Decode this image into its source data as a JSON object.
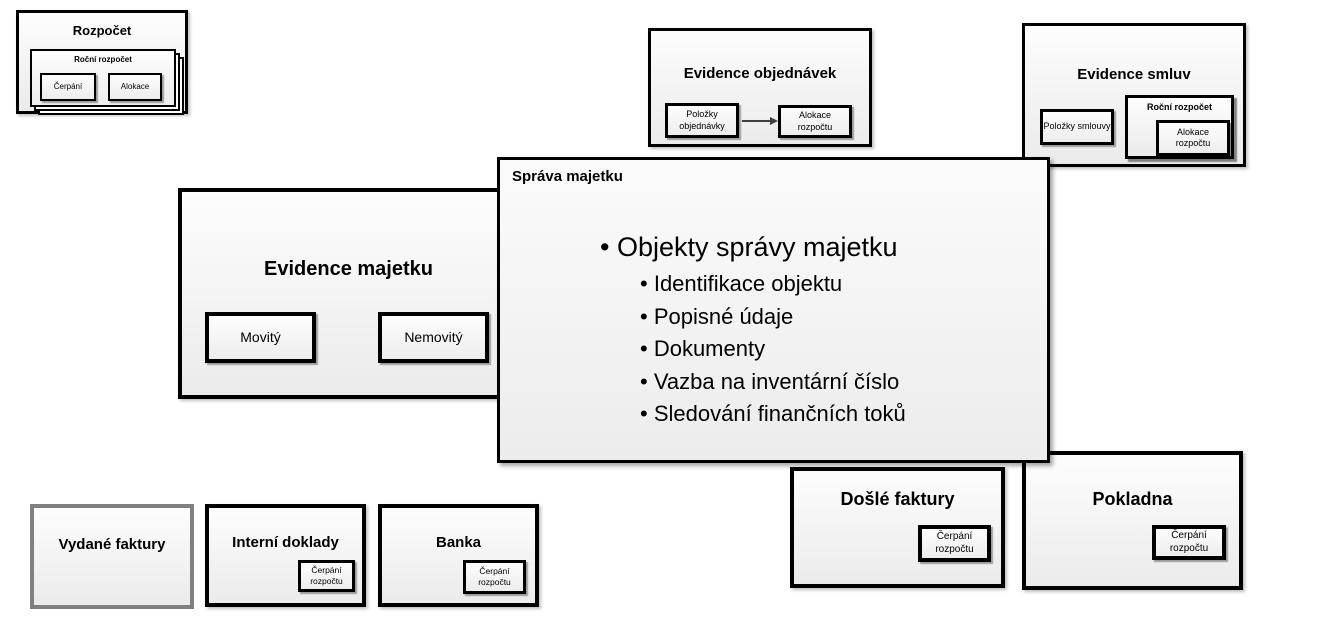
{
  "palette": {
    "border_black": "#000000",
    "border_gray": "#808080",
    "box_fill_top": "#fdfdfd",
    "box_fill_bottom": "#ebebeb",
    "arrow_color": "#404040",
    "text_color": "#000000"
  },
  "diagram": {
    "rozpocet": {
      "title": "Rozpočet",
      "rocni_rozpocet": {
        "title": "Roční rozpočet",
        "cerpani": "Čerpání",
        "alokace": "Alokace"
      }
    },
    "evidence_objednavek": {
      "title": "Evidence objednávek",
      "polozky_objednavky": "Položky objednávky",
      "alokace_rozpoctu": "Alokace rozpočtu"
    },
    "evidence_smluv": {
      "title": "Evidence smluv",
      "polozky_smlouvy": "Položky smlouvy",
      "rocni_rozpocet": {
        "title": "Roční rozpočet",
        "alokace_rozpoctu": "Alokace rozpočtu"
      }
    },
    "evidence_majetku": {
      "title": "Evidence majetku",
      "movity": "Movitý",
      "nemovity": "Nemovitý"
    },
    "sprava_majetku": {
      "title": "Správa majetku",
      "bullet_main": "Objekty správy majetku",
      "sub_bullets": [
        "Identifikace objektu",
        "Popisné údaje",
        "Dokumenty",
        "Vazba na inventární číslo",
        "Sledování finančních toků"
      ]
    },
    "dosle_faktury": {
      "title": "Došlé faktury",
      "cerpani_rozpoctu": "Čerpání rozpočtu"
    },
    "pokladna": {
      "title": "Pokladna",
      "cerpani_rozpoctu": "Čerpání rozpočtu"
    },
    "vydane_faktury": {
      "title": "Vydané faktury"
    },
    "interni_doklady": {
      "title": "Interní doklady",
      "cerpani_rozpoctu": "Čerpání rozpočtu"
    },
    "banka": {
      "title": "Banka",
      "cerpani_rozpoctu": "Čerpání rozpočtu"
    }
  }
}
